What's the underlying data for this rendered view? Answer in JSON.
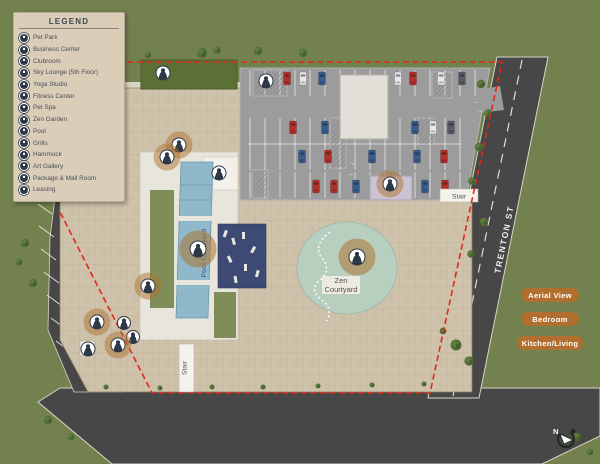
{
  "legend": {
    "title": "LEGEND",
    "items": [
      "Pet Park",
      "Business Center",
      "Clubroom",
      "Sky Lounge (5th Floor)",
      "Yoga Studio",
      "Fitness Center",
      "Pet Spa",
      "Zen Garden",
      "Pool",
      "Grills",
      "Hammock",
      "Art Gallery",
      "Package & Mail Room",
      "Leasing"
    ]
  },
  "map": {
    "street_name": "TRENTON ST",
    "pool_courtyard_label": "Pool Courtyard",
    "zen_courtyard_label_line1": "Zen",
    "zen_courtyard_label_line2": "Courtyard",
    "stair_label_east": "Stair",
    "stair_label_south": "Stair",
    "compass_north_label": "N",
    "markers": [
      {
        "id": "pet-park",
        "label": "Pet Park",
        "x": 163,
        "y": 73,
        "halo": "none",
        "size": 13
      },
      {
        "id": "business-center",
        "label": "Business Center",
        "x": 266,
        "y": 81,
        "halo": "none",
        "size": 13
      },
      {
        "id": "clubroom",
        "label": "Clubroom",
        "x": 219,
        "y": 173,
        "halo": "none",
        "size": 13
      },
      {
        "id": "sky-lounge",
        "label": "Sky Lounge (5th Floor)",
        "x": 179,
        "y": 145,
        "halo": "sm",
        "size": 13
      },
      {
        "id": "fitness-center",
        "label": "Fitness Center",
        "x": 167,
        "y": 157,
        "halo": "sm",
        "size": 13
      },
      {
        "id": "pool",
        "label": "Pool",
        "x": 198,
        "y": 249,
        "halo": "lg",
        "size": 15
      },
      {
        "id": "zen-garden",
        "label": "Zen Garden",
        "x": 357,
        "y": 257,
        "halo": "lg",
        "size": 15
      },
      {
        "id": "package-mail-room",
        "label": "Package & Mail Room",
        "x": 390,
        "y": 184,
        "halo": "sm",
        "size": 13
      },
      {
        "id": "hammock",
        "label": "Hammock",
        "x": 148,
        "y": 286,
        "halo": "sm",
        "size": 13
      },
      {
        "id": "yoga-studio",
        "label": "Yoga Studio",
        "x": 97,
        "y": 322,
        "halo": "sm",
        "size": 13
      },
      {
        "id": "grills",
        "label": "Grills",
        "x": 124,
        "y": 323,
        "halo": "none",
        "size": 12
      },
      {
        "id": "pet-spa",
        "label": "Pet Spa",
        "x": 133,
        "y": 337,
        "halo": "none",
        "size": 12
      },
      {
        "id": "art-gallery",
        "label": "Art Gallery",
        "x": 118,
        "y": 345,
        "halo": "sm",
        "size": 13
      },
      {
        "id": "leasing",
        "label": "Leasing",
        "x": 88,
        "y": 349,
        "halo": "none",
        "size": 13
      }
    ]
  },
  "view_buttons": [
    {
      "id": "aerial-view",
      "label": "Aerial View"
    },
    {
      "id": "bedroom",
      "label": "Bedroom"
    },
    {
      "id": "kitchen-living",
      "label": "Kitchen/Living"
    }
  ],
  "colors": {
    "background_green": "#73814e",
    "building_tan": "#cfc2aa",
    "road_gray": "#474747",
    "parking_gray": "#9c9c9c",
    "pool_blue": "#8fb8cb",
    "zen_green": "#b8cfc0",
    "boundary_red": "#e02818",
    "button_orange": "#b06f2e",
    "marker_halo": "#ad7432",
    "legend_bg": "#dbceb9"
  }
}
